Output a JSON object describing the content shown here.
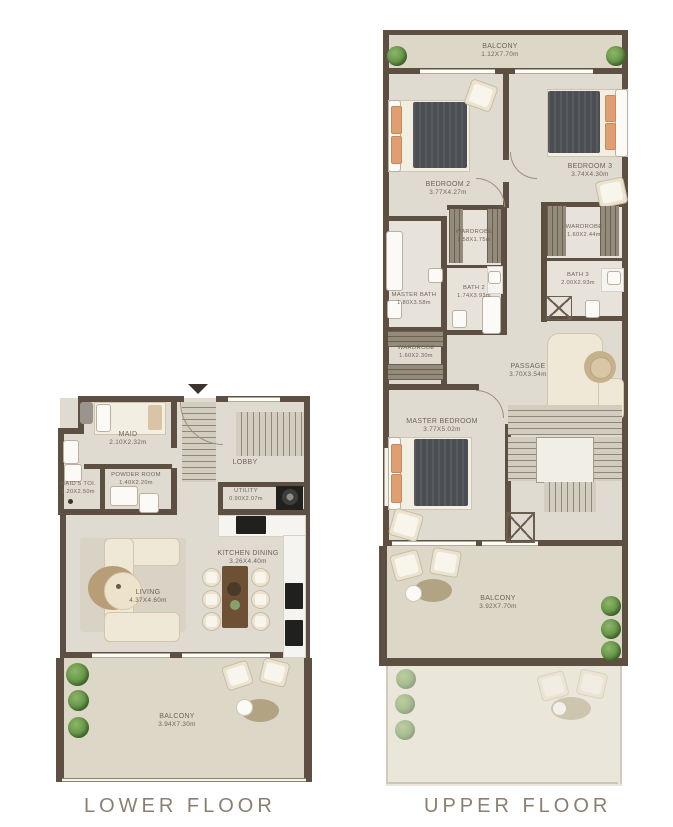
{
  "titles": {
    "lower": "LOWER FLOOR",
    "upper": "UPPER FLOOR"
  },
  "colors": {
    "wall": "#5d5043",
    "floor": "#e0dbd0",
    "balcony_floor": "#ddd7c7",
    "label_text": "#6f655a",
    "title_text": "#8b7f71",
    "plant_green": "#6a9a4b",
    "bed_blanket": "#4b4e53",
    "pillow_orange": "#df9f70"
  },
  "lower": {
    "maid": {
      "name": "MAID",
      "dims": "2.10X2.32m"
    },
    "maids_toi": {
      "name": "MAID'S TOI.",
      "dims": "1.20X2.50m"
    },
    "powder": {
      "name": "POWDER ROOM",
      "dims": "1.40X2.20m"
    },
    "lobby": {
      "name": "LOBBY"
    },
    "utility": {
      "name": "UTILITY",
      "dims": "0.90X2.07m"
    },
    "living": {
      "name": "LIVING",
      "dims": "4.37X4.60m"
    },
    "kitchen": {
      "name": "KITCHEN DINING",
      "dims": "3.26X4.40m"
    },
    "balcony": {
      "name": "BALCONY",
      "dims": "3.94X7.30m"
    }
  },
  "upper": {
    "balcony_top": {
      "name": "BALCONY",
      "dims": "1.12X7.70m"
    },
    "bedroom2": {
      "name": "BEDROOM 2",
      "dims": "3.77X4.27m"
    },
    "bedroom3": {
      "name": "BEDROOM 3",
      "dims": "3.74X4.30m"
    },
    "wardrobe_mid": {
      "name": "WARDROBE",
      "dims": "1.58X1.75m"
    },
    "bath2": {
      "name": "BATH 2",
      "dims": "1.74X3.93m"
    },
    "wardrobe_right": {
      "name": "WARDROBE",
      "dims": "1.60X2.44m"
    },
    "bath3": {
      "name": "BATH 3",
      "dims": "2.00X2.93m"
    },
    "master_bath": {
      "name": "MASTER BATH",
      "dims": "1.80X3.58m"
    },
    "wardrobe_master": {
      "name": "WARDROBE",
      "dims": "1.60X2.30m"
    },
    "passage": {
      "name": "PASSAGE",
      "dims": "3.70X3.54m"
    },
    "master_bedroom": {
      "name": "MASTER BEDROOM",
      "dims": "3.77X5.02m"
    },
    "balcony_bottom": {
      "name": "BALCONY",
      "dims": "3.92X7.70m"
    }
  }
}
